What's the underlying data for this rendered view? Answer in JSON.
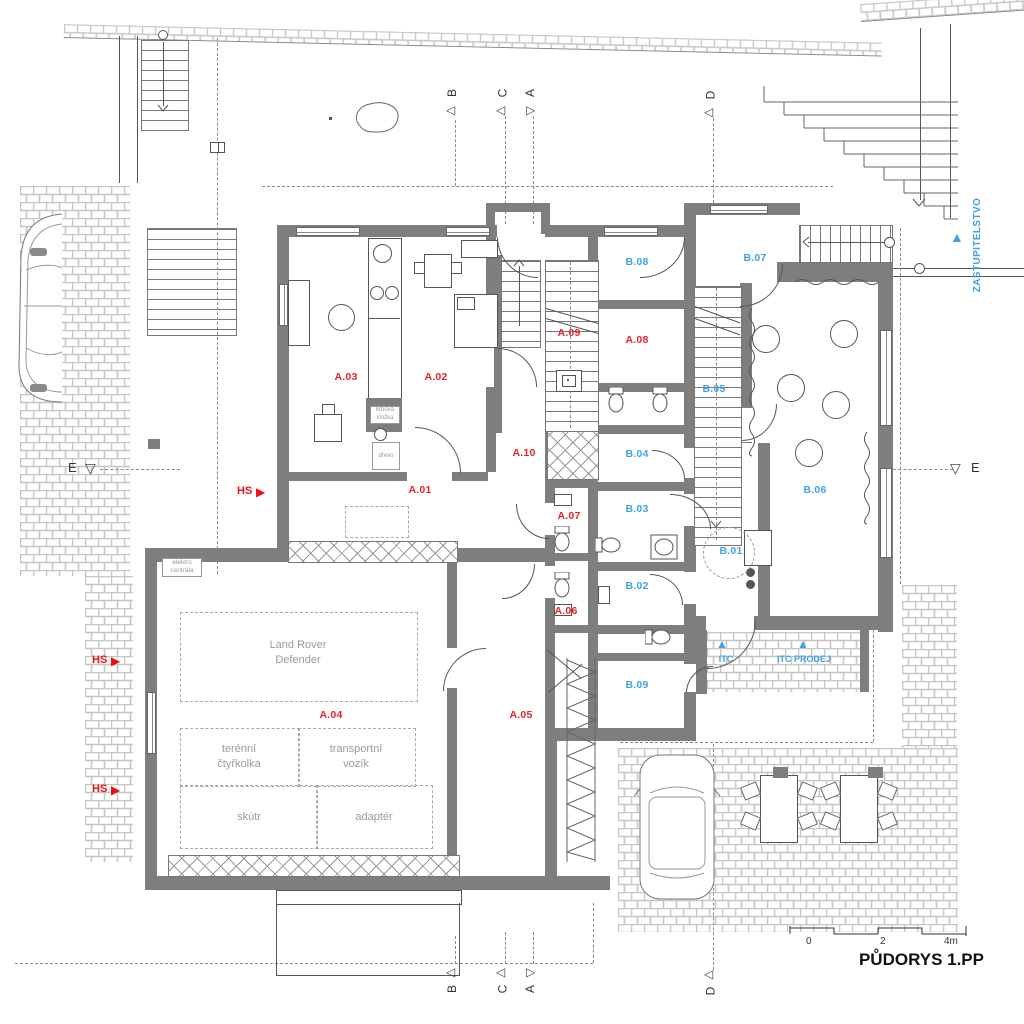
{
  "colors": {
    "wall": "#7e7e7e",
    "red": "#e2232b",
    "blue": "#41a1e4",
    "gray_text": "#9a9a9a"
  },
  "rooms": {
    "a01": "A.01",
    "a02": "A.02",
    "a03": "A.03",
    "a04": "A.04",
    "a05": "A.05",
    "a06": "A.06",
    "a07": "A.07",
    "a08": "A.08",
    "a09": "A.09",
    "a10": "A.10",
    "b01": "B.01",
    "b02": "B.02",
    "b03": "B.03",
    "b04": "B.04",
    "b05": "B.05",
    "b06": "B.06",
    "b07": "B.07",
    "b08": "B.08",
    "b09": "B.09"
  },
  "site": {
    "zastupitelstvo": "ZASTUPITELSTVO",
    "itc": "ITC",
    "itc_prodej": "ITC PRODEJ",
    "hs": "HS"
  },
  "sections": {
    "a": "A",
    "b": "B",
    "c": "C",
    "d": "D",
    "e": "E"
  },
  "garage": {
    "vehicle_line1": "Land Rover",
    "vehicle_line2": "Defender",
    "quad_line1": "terénní",
    "quad_line2": "čtyřkolka",
    "trailer_line1": "transportní",
    "trailer_line2": "vozík",
    "scooter": "skútr",
    "adapter": "adaptér",
    "electro_line1": "elektro",
    "electro_line2": "centrála"
  },
  "fireplace": {
    "line1": "krbová",
    "line2": "vložka",
    "wood": "dřevo"
  },
  "titleblock": {
    "title": "PŮDORYS 1.PP",
    "scale_0": "0",
    "scale_2": "2",
    "scale_4": "4m"
  }
}
